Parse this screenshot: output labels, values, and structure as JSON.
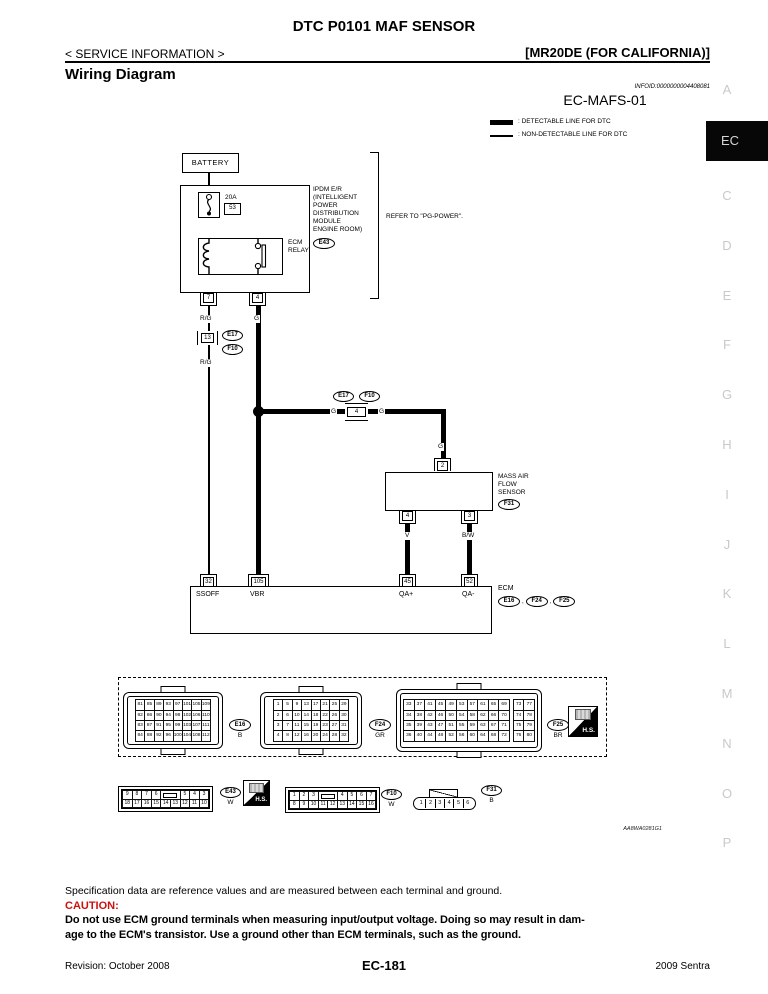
{
  "header": {
    "doc_title": "DTC P0101 MAF SENSOR",
    "service_info": "< SERVICE INFORMATION >",
    "engine_variant": "[MR20DE (FOR CALIFORNIA)]",
    "section_heading": "Wiring Diagram",
    "infoid": "INFOID:0000000004408081"
  },
  "sidebar": {
    "letters_before": [
      "A"
    ],
    "active": "EC",
    "letters_after": [
      "C",
      "D",
      "E",
      "F",
      "G",
      "H",
      "I",
      "J",
      "K",
      "L",
      "M",
      "N",
      "O",
      "P"
    ]
  },
  "diagram": {
    "code": "EC-MAFS-01",
    "legend": [
      {
        "style": "thick",
        "label": ": DETECTABLE LINE FOR DTC"
      },
      {
        "style": "thin",
        "label": ": NON-DETECTABLE LINE FOR DTC"
      }
    ],
    "battery": "BATTERY",
    "fuse_amp": "20A",
    "fuse_no": "53",
    "relay_name_lines": [
      "ECM",
      "RELAY"
    ],
    "ipdm_lines": [
      "IPDM E/R",
      "(INTELLIGENT",
      "POWER",
      "DISTRIBUTION",
      "MODULE",
      "ENGINE ROOM)"
    ],
    "ipdm_connector": "E43",
    "refer_note": "REFER TO \"PG-POWER\".",
    "ipdm_terminal_left": "7",
    "ipdm_terminal_right": "4",
    "wire_rg": "R/G",
    "wire_g": "G",
    "wire_v": "V",
    "wire_bw": "B/W",
    "inline13_pin": "13",
    "inline4_pin": "4",
    "conn_e17": "E17",
    "conn_f10": "F10",
    "maf_lines": [
      "MASS AIR",
      "FLOW",
      "SENSOR"
    ],
    "maf_connector": "F31",
    "maf_top_terminal": "2",
    "maf_terminal_left": "4",
    "maf_terminal_right": "3",
    "ecm_name": "ECM",
    "ecm_sep": ",",
    "ecm_connectors": [
      "E16",
      "F24",
      "F25"
    ],
    "ecm_terminals": [
      {
        "pin": "32",
        "name": "SSOFF"
      },
      {
        "pin": "105",
        "name": "VBR"
      },
      {
        "pin": "45",
        "name": "QA+"
      },
      {
        "pin": "52",
        "name": "QA-"
      }
    ],
    "artwork_code": "AA8WA0281G1"
  },
  "connector_views": {
    "hs_label": "H.S.",
    "ecm_grids": [
      {
        "id": "E16",
        "color": "B",
        "rows": [
          [
            "81",
            "85",
            "89",
            "93",
            "97",
            "101",
            "105",
            "109"
          ],
          [
            "82",
            "86",
            "90",
            "94",
            "98",
            "102",
            "106",
            "110"
          ],
          [
            "83",
            "87",
            "91",
            "95",
            "99",
            "103",
            "107",
            "111"
          ],
          [
            "84",
            "88",
            "92",
            "96",
            "100",
            "104",
            "108",
            "112"
          ]
        ]
      },
      {
        "id": "F24",
        "color": "GR",
        "rows": [
          [
            "1",
            "5",
            "9",
            "13",
            "17",
            "21",
            "25",
            "29"
          ],
          [
            "2",
            "6",
            "10",
            "14",
            "18",
            "22",
            "26",
            "30"
          ],
          [
            "3",
            "7",
            "11",
            "15",
            "19",
            "23",
            "27",
            "31"
          ],
          [
            "4",
            "8",
            "12",
            "16",
            "20",
            "24",
            "28",
            "32"
          ]
        ]
      },
      {
        "id": "F25",
        "color": "BR",
        "gap_before": 10,
        "rows": [
          [
            "33",
            "37",
            "41",
            "45",
            "49",
            "53",
            "57",
            "61",
            "65",
            "69",
            "73",
            "77"
          ],
          [
            "34",
            "38",
            "42",
            "46",
            "50",
            "54",
            "58",
            "62",
            "66",
            "70",
            "74",
            "78"
          ],
          [
            "35",
            "39",
            "43",
            "47",
            "51",
            "55",
            "59",
            "63",
            "67",
            "71",
            "75",
            "79"
          ],
          [
            "36",
            "40",
            "44",
            "48",
            "52",
            "56",
            "60",
            "64",
            "68",
            "72",
            "76",
            "80"
          ]
        ]
      }
    ],
    "e43": {
      "id": "E43",
      "color": "W",
      "rows": [
        [
          "9",
          "8",
          "7",
          "6",
          "",
          "5",
          "4",
          "3"
        ],
        [
          "18",
          "17",
          "16",
          "15",
          "14",
          "13",
          "12",
          "11",
          "10"
        ]
      ]
    },
    "f10": {
      "id": "F10",
      "color": "W",
      "rows": [
        [
          "1",
          "2",
          "3",
          "",
          "4",
          "5",
          "6",
          "7"
        ],
        [
          "8",
          "9",
          "10",
          "11",
          "12",
          "13",
          "14",
          "15",
          "16"
        ]
      ]
    },
    "f31": {
      "id": "F31",
      "color": "B",
      "pins": [
        "1",
        "2",
        "3",
        "4",
        "5",
        "6"
      ]
    }
  },
  "notes": {
    "spec": "Specification data are reference values and are measured between each terminal and ground.",
    "caution_label": "CAUTION:",
    "caution_lines": [
      "Do not use ECM ground terminals when measuring input/output voltage. Doing so may result in dam-",
      "age to the ECM's transistor. Use a ground other than ECM terminals, such as the ground."
    ]
  },
  "footer": {
    "revision": "Revision: October 2008",
    "page": "EC-181",
    "model": "2009 Sentra"
  }
}
